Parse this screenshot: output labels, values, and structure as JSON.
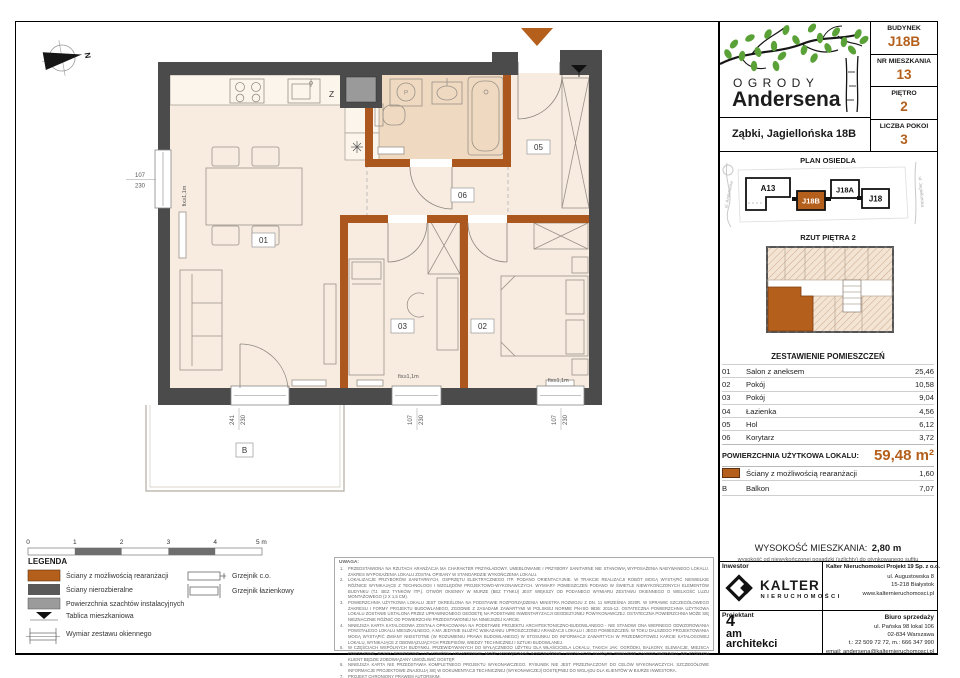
{
  "colors": {
    "accent": "#b45f1b",
    "wall_orange": "#ac571d",
    "wall_dark": "#4b4b4b",
    "floor": "#f8ece1",
    "floor_bath": "#efd9c1",
    "shaft_gray": "#9a9a9a",
    "leaf_green": "#5aa237"
  },
  "header": {
    "brand_line1": "OGRODY",
    "brand_line2": "Andersena",
    "address": "Ząbki, Jagiellońska 18B",
    "info": [
      {
        "label": "BUDYNEK",
        "value": "J18B"
      },
      {
        "label": "NR MIESZKANIA",
        "value": "13"
      },
      {
        "label": "PIĘTRO",
        "value": "2"
      },
      {
        "label": "LICZBA POKOI",
        "value": "3"
      }
    ]
  },
  "site_plan": {
    "title": "PLAN OSIEDLA",
    "buildings": {
      "a13": "A13",
      "j18b": "J18B",
      "j18a": "J18A",
      "j18": "J18"
    },
    "streets": {
      "left": "ul. Andersena",
      "right": "ul. Jagiellońska"
    }
  },
  "floor_overview": {
    "title": "RZUT PIĘTRA 2"
  },
  "rooms_table": {
    "title": "ZESTAWIENIE POMIESZCZEŃ",
    "rows": [
      {
        "no": "01",
        "name": "Salon z aneksem",
        "area": "25,46"
      },
      {
        "no": "02",
        "name": "Pokój",
        "area": "10,58"
      },
      {
        "no": "03",
        "name": "Pokój",
        "area": "9,04"
      },
      {
        "no": "04",
        "name": "Łazienka",
        "area": "4,56"
      },
      {
        "no": "05",
        "name": "Hol",
        "area": "6,12"
      },
      {
        "no": "06",
        "name": "Korytarz",
        "area": "3,72"
      }
    ],
    "total_label": "POWIERZCHNIA UŻYTKOWA LOKALU:",
    "total_value": "59,48 m²",
    "walls_row": {
      "label": "Ściany z możliwością rearanżacji",
      "area": "1,60"
    },
    "balcony_row": {
      "no": "B",
      "label": "Balkon",
      "area": "7,07"
    }
  },
  "height_info": {
    "label": "WYSOKOŚĆ MIESZKANIA:",
    "value": "2,80 m",
    "note": "wysokość od niewykończonej posadzki (szlichty) do otynkowanego sufitu"
  },
  "footer": {
    "investor_label": "Inwestor",
    "investor_logo_text": "KALTER",
    "investor_logo_sub": "nieruchomości",
    "company_name": "Kalter Nieruchomości Projekt 19 Sp. z o.o.",
    "company_lines": [
      "ul. Augustowska 8",
      "15-218 Białystok",
      "www.kalternieruchomosci.pl"
    ],
    "designer_label": "Projektant",
    "designer_line1": "4",
    "designer_line2": "am",
    "designer_line3": "architekci",
    "office_label": "Biuro sprzedaży",
    "office_lines": [
      "ul. Pańska 98 lokal 106",
      "02-834 Warszawa",
      "t.: 22 509 72 72, m.: 666 347 990",
      "email: andersena@kalternieruchomosci.pl"
    ]
  },
  "legend": {
    "title": "LEGENDA",
    "scale_ticks": [
      "0",
      "1",
      "2",
      "3",
      "4"
    ],
    "scale_last": "5 m",
    "col1": [
      "Ściany z możliwością rearanżacji",
      "Ściany nierozbieralne",
      "Powierzchnia szachtów instalacyjnych",
      "Tablica mieszkaniowa",
      "Wymiar zestawu okiennego"
    ],
    "col2": [
      "Grzejnik c.o.",
      "Grzejnik łazienkowy"
    ]
  },
  "plan": {
    "north": "N",
    "rooms": {
      "r01": "01",
      "r02": "02",
      "r03": "03",
      "r05": "05",
      "r06": "06",
      "balcony": "B",
      "kitchen": "Z"
    },
    "window_note": "fix≥1,1m",
    "dims": {
      "left": [
        "107",
        "230"
      ],
      "balcony_door": [
        "241",
        "230"
      ],
      "win03": [
        "107",
        "230"
      ],
      "win02": [
        "107",
        "230"
      ]
    }
  },
  "notes": {
    "title": "UWAGA:",
    "items": [
      "PRZEDSTAWIONA NA RZUTACH ARANŻACJA MA CHARAKTER PRZYKŁADOWY. UMEBLOWANIE I PRZYBORY SANITARNE NIE STANOWIĄ WYPOSAŻENIA NABYWANEGO LOKALU. ZAKRES WYPOSAŻENIA LOKALU ZOSTAŁ OPISANY W STANDARDZIE WYKOŃCZENIA LOKALU.",
      "LOKALIZACJE PRZYBORÓW SANITARNYCH, OSPRZĘTU ELEKTRYCZNEGO ITP. PODANO ORIENTACYJNIE. W TRAKCIE REALIZACJI ROBÓT MOGĄ WYSTĄPIĆ NIEWIELKIE RÓŻNICE WYNIKAJĄCE Z TECHNOLOGII I WZGLĘDÓW PROJEKTOWO-WYKONAWCZYCH. WYMIARY POMIESZCZEŃ PODANO W ŚWIETLE NIEWYKOŃCZONYCH ELEMENTÓW BUDYNKU (TJ. BEZ TYNKÓW ITP.). OTWÓR OKIENNY W MURZE (BEZ TYNKU) JEST WIĘKSZY OD PODANEGO WYMIARU ZESTAWU OKIENNEGO O WIELKOŚĆ LUZU MONTAŻOWEGO (2 X 1,5 CM).",
      "POWIERZCHNIA UŻYTKOWA LOKALU JEST OKREŚLONA NA PODSTAWIE ROZPORZĄDZENIA MINISTRA ROZWOJU Z DN. 11 WRZEŚNIA 2020R. W SPRAWIE SZCZEGÓŁOWEGO ZAKRESU I FORMY PROJEKTU BUDOWLANEGO, ZGODNIE Z ZASADAMI ZAWARTYMI W POLSKIEJ NORMIE PN-ISO 9836: 2015-12. OSTATECZNA POWIERZCHNIA UŻYTKOWA LOKALU ZOSTANIE USTALONA PRZEZ UPRAWNIONEGO GEODETĘ NA PODSTAWIE INWENTARYZACJI GEODEZYJNEJ POWYKONAWCZEJ. OSTATECZNA POWIERZCHNIA MOŻE SIĘ NIEZNACZNIE RÓŻNIĆ OD POWIERZCHNI PRZEDSTAWIONEJ NA NINIEJSZEJ KARCIE.",
      "NINIEJSZA KARTA KATALOGOWA ZOSTAŁA OPRACOWANA NA PODSTAWIE PROJEKTU ARCHITEKTONICZNO-BUDOWLANEGO - NIE STANOWI ONA WIERNEGO ODWZOROWANIA POWSTAŁEGO LOKALU MIESZKALNEGO, A MA JEDYNIE SŁUŻYĆ WSKAZANIU UPROSZCZONEJ ARANŻACJI LOKALU I JEGO POMIESZCZEŃ. W TOKU DALSZEGO PROJEKTOWANIA MOGĄ WYSTĄPIĆ ZMIANY NIEISTOTNE (W ROZUMIENIU PRAWA BUDOWLANEGO) W STOSUNKU DO INFORMACJI ZAWARTYCH W PRZEDMIOTOWEJ KARCIE KATALOGOWEJ LOKALU, WYNIKAJĄCE Z OBOWIĄZUJĄCYCH PRZEPISÓW, WIEDZY TECHNICZNEJ I SZTUKI BUDOWLANEJ.",
      "W CZĘŚCIACH WSPÓLNYCH BUDYNKU, PRZEWIDYWANYCH DO WYŁĄCZNEGO UŻYTKU DLA WŁAŚCICIELA LOKALU, TAKICH JAK: OGRÓDKI, BALKONY, ELEWACJE, MIEJSCA POSTOJOWE, BOKSY ROWEROWE LUB KOMÓRKI LOKATORSKIE, MOŻE WYSTĘPOWAĆ WYPOSAŻENIE I INSTALACJE SŁUŻĄCE OBSŁUDZE CAŁEGO BUDYNKU, DO KTÓRYCH KLIENT BĘDZIE ZOBOWIĄZANY UMOŻLIWIĆ DOSTĘP.",
      "NINIEJSZA KARTA NIE PRZEDSTAWIA KOMPLETNEGO PROJEKTU WYKONAWCZEGO. RYSUNEK NIE JEST PRZEZNACZONY DO CELÓW WYKONAWCZYCH. SZCZEGÓŁOWE INFORMACJE PROJEKTOWE ZNAJDUJĄ SIĘ W DOKUMENTACJI TECHNICZNEJ (WYKONAWCZEJ) DOSTĘPNEJ DO WGLĄDU DLA KLIENTÓW W BIURZE INWESTORA.",
      "PROJEKT CHRONIONY PRAWEM AUTORSKIM."
    ]
  }
}
